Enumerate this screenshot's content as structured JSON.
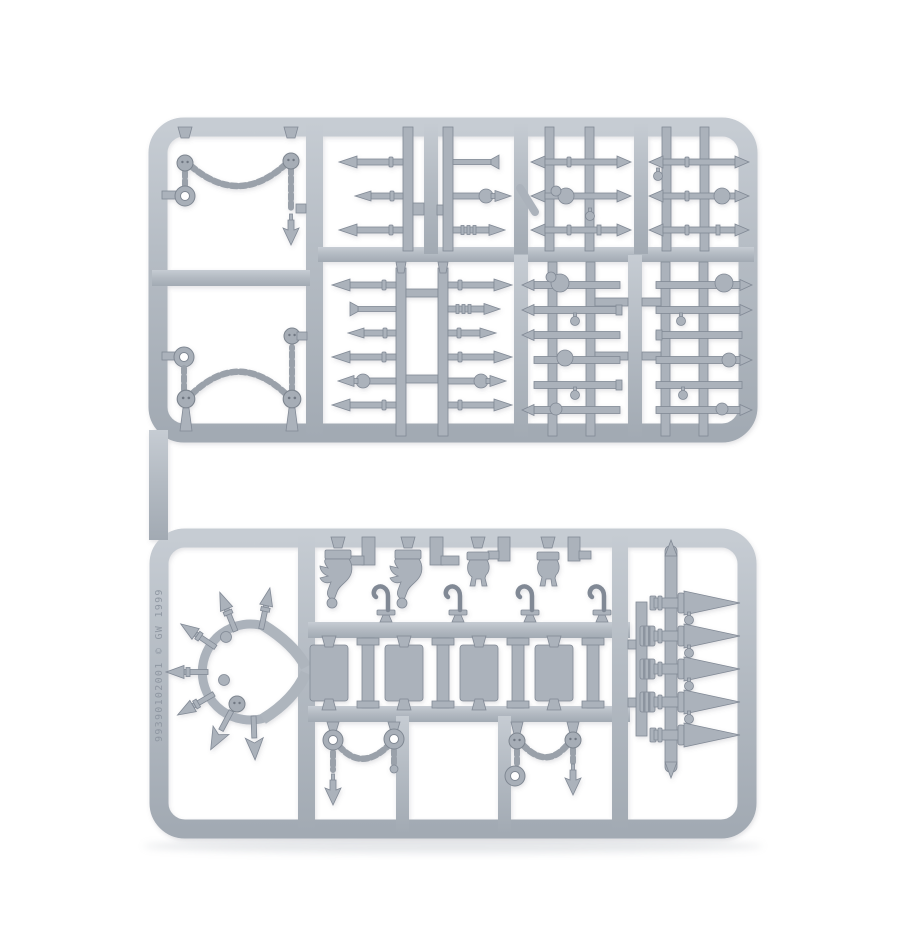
{
  "photo": {
    "subject": "Gray plastic model kit sprue photographed on a plain white background",
    "orientation": "portrait"
  },
  "sprue": {
    "molded_text": "99390102001 © GW 1999",
    "part_code": "99390102001",
    "maker_initials": "GW",
    "year": "1999",
    "colors": {
      "plastic_base": "#b4bbc3",
      "plastic_light": "#c8cdd4",
      "plastic_dark": "#a2aab3",
      "part_fill": "#abb2bb",
      "outline": "#818995",
      "background": "#ffffff"
    },
    "sections": {
      "upper_left": [
        "draped chain with ring, two skull beads and spearhead pendant",
        "arched chain with ring and three skull beads"
      ],
      "upper_grid": [
        "3 short spear tips pointing left",
        "3 short spear tips with skull pointing right",
        "3 double-ended spears with skull beads",
        "3 double-ended spears with skull beads",
        "6 long spear tips pointing left",
        "6 long spear tips pointing right",
        "6 decorated spear shafts on ladder runner",
        "6 decorated spear shafts on ladder runner"
      ],
      "lower_left": [
        "spiked crescent ornament with skull bead and barbed arrow spikes"
      ],
      "lower_middle": [
        "2 large beast-head standard tops",
        "2 small beast-head standard tops",
        "4 S-hooks",
        "4 rectangular plates",
        "4 I-beam posts",
        "2 hanging chains with ring, skull and spearhead pendants"
      ],
      "lower_right": [
        "5 large conical spikes on vertical runner"
      ]
    }
  }
}
